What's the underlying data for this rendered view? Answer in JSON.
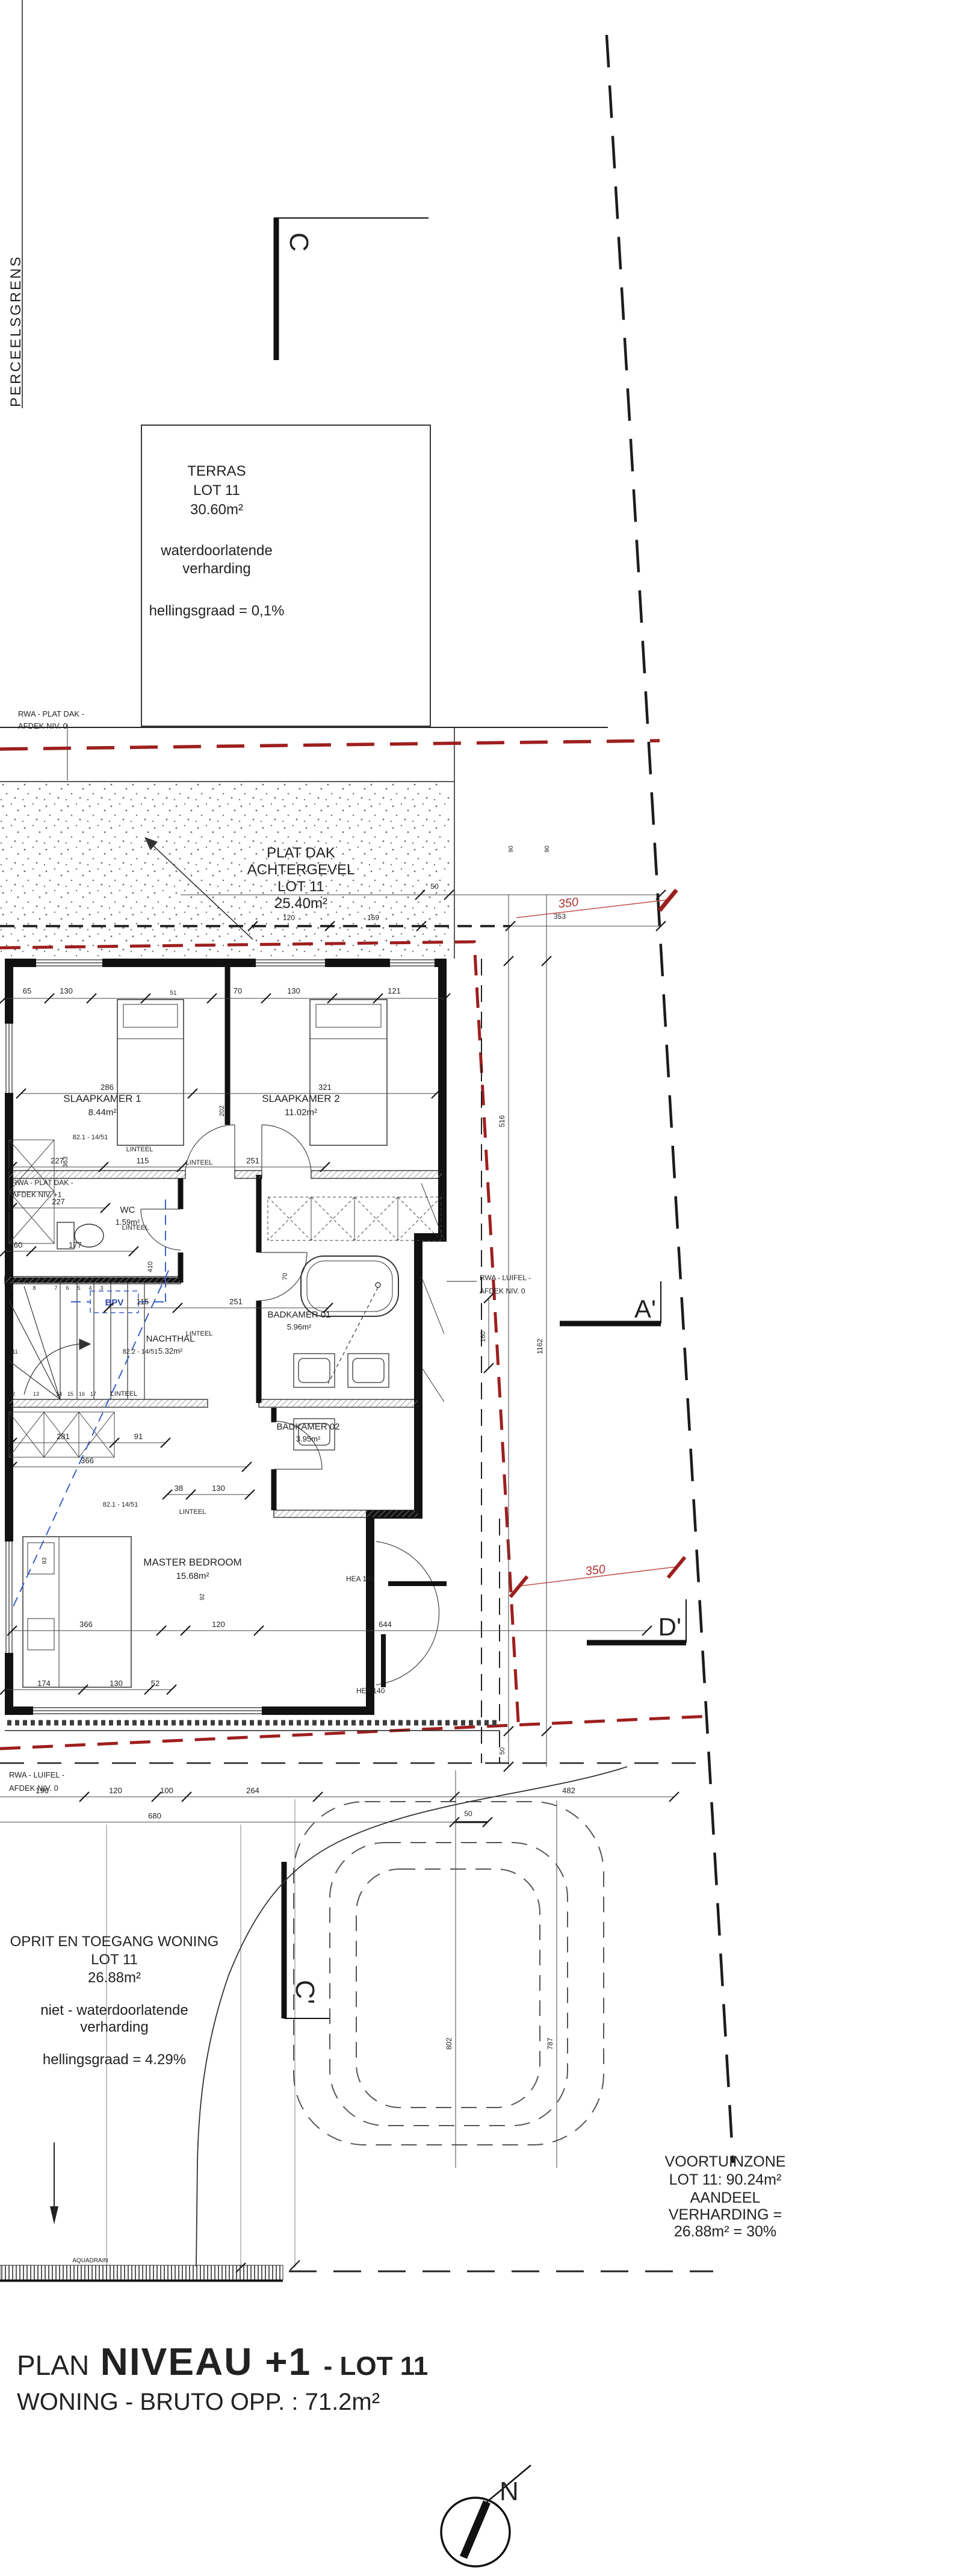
{
  "colors": {
    "line": "#1c1c1c",
    "red_boundary": "#9e1f1f",
    "red_dim": "#c0504d",
    "blue": "#3a5fc8"
  },
  "title": {
    "prefix": "PLAN",
    "main": "NIVEAU +1",
    "suffix": "- LOT 11",
    "subtitle": "WONING - BRUTO OPP. : 71.2m²"
  },
  "compass": {
    "north": "N"
  },
  "boundary": {
    "label": "PERCEELSGRENS"
  },
  "sections": {
    "c": "C",
    "c_prime": "C'",
    "a_prime": "A'",
    "d_prime": "D'"
  },
  "zones": {
    "terras": {
      "name": "TERRAS",
      "lot": "LOT 11",
      "area": "30.60m²",
      "note1": "waterdoorlatende",
      "note2": "verharding",
      "slope": "hellingsgraad = 0,1%"
    },
    "plat_dak": {
      "name": "PLAT DAK",
      "sub": "ACHTERGEVEL",
      "lot": "LOT 11",
      "area": "25.40m²"
    },
    "oprit": {
      "name": "OPRIT EN TOEGANG WONING",
      "lot": "LOT 11",
      "area": "26.88m²",
      "note1": "niet - waterdoorlatende",
      "note2": "verharding",
      "slope": "hellingsgraad = 4.29%"
    },
    "voortuin": {
      "l1": "VOORTUINZONE",
      "l2": "LOT 11: 90.24m²",
      "l3": "AANDEEL",
      "l4": "VERHARDING =",
      "l5": "26.88m² = 30%"
    }
  },
  "rooms": [
    {
      "name": "SLAAPKAMER 1",
      "area": "8.44m²"
    },
    {
      "name": "SLAAPKAMER 2",
      "area": "11.02m²"
    },
    {
      "name": "WC",
      "area": "1.59m²"
    },
    {
      "name": "NACHTHAL",
      "area": "5.32m²"
    },
    {
      "name": "BADKAMER 01",
      "area": "5.96m²"
    },
    {
      "name": "BADKAMER 02",
      "area": "3.95m²"
    },
    {
      "name": "MASTER BEDROOM",
      "area": "15.68m²"
    }
  ],
  "notes": {
    "rwa_top_1": "RWA - PLAT DAK -",
    "rwa_top_2": "AFDEK NIV. 0",
    "rwa_niv1_1": "RWA - PLAT DAK -",
    "rwa_niv1_2": "AFDEK NIV. +1",
    "rwa_luifel_1": "RWA - LUIFEL -",
    "rwa_luifel_2": "AFDEK NIV. 0",
    "hea": "HEA 140",
    "linteel": "LINTEEL",
    "bpv": "BPV",
    "levels": [
      "82.2 - 14/51",
      "82.1 - 14/51"
    ],
    "aquadrain": "AQUADRAIN"
  },
  "dims": {
    "red350": "350",
    "top": [
      "65",
      "130",
      "51",
      "70",
      "130",
      "121"
    ],
    "beds": [
      "286",
      "321",
      "202",
      "363"
    ],
    "hall": [
      "227",
      "115",
      "251",
      "227",
      "60",
      "177",
      "115",
      "251",
      "410",
      "70"
    ],
    "closets": [
      "281",
      "91",
      "366"
    ],
    "bk2": [
      "38",
      "130"
    ],
    "master": [
      "366",
      "120",
      "644",
      "93",
      "92"
    ],
    "front": [
      "174",
      "130",
      "52"
    ],
    "site": [
      "196",
      "120",
      "100",
      "264",
      "482",
      "680",
      "50"
    ],
    "right": [
      "50",
      "120",
      "169",
      "353",
      "90",
      "90",
      "516",
      "1162",
      "160",
      "50"
    ],
    "garden": [
      "802",
      "787"
    ],
    "stairs_a": [
      "9",
      "8",
      "7",
      "6",
      "5",
      "4",
      "3"
    ],
    "stairs_b": [
      "11",
      "12",
      "13",
      "14",
      "15",
      "16",
      "17"
    ]
  }
}
